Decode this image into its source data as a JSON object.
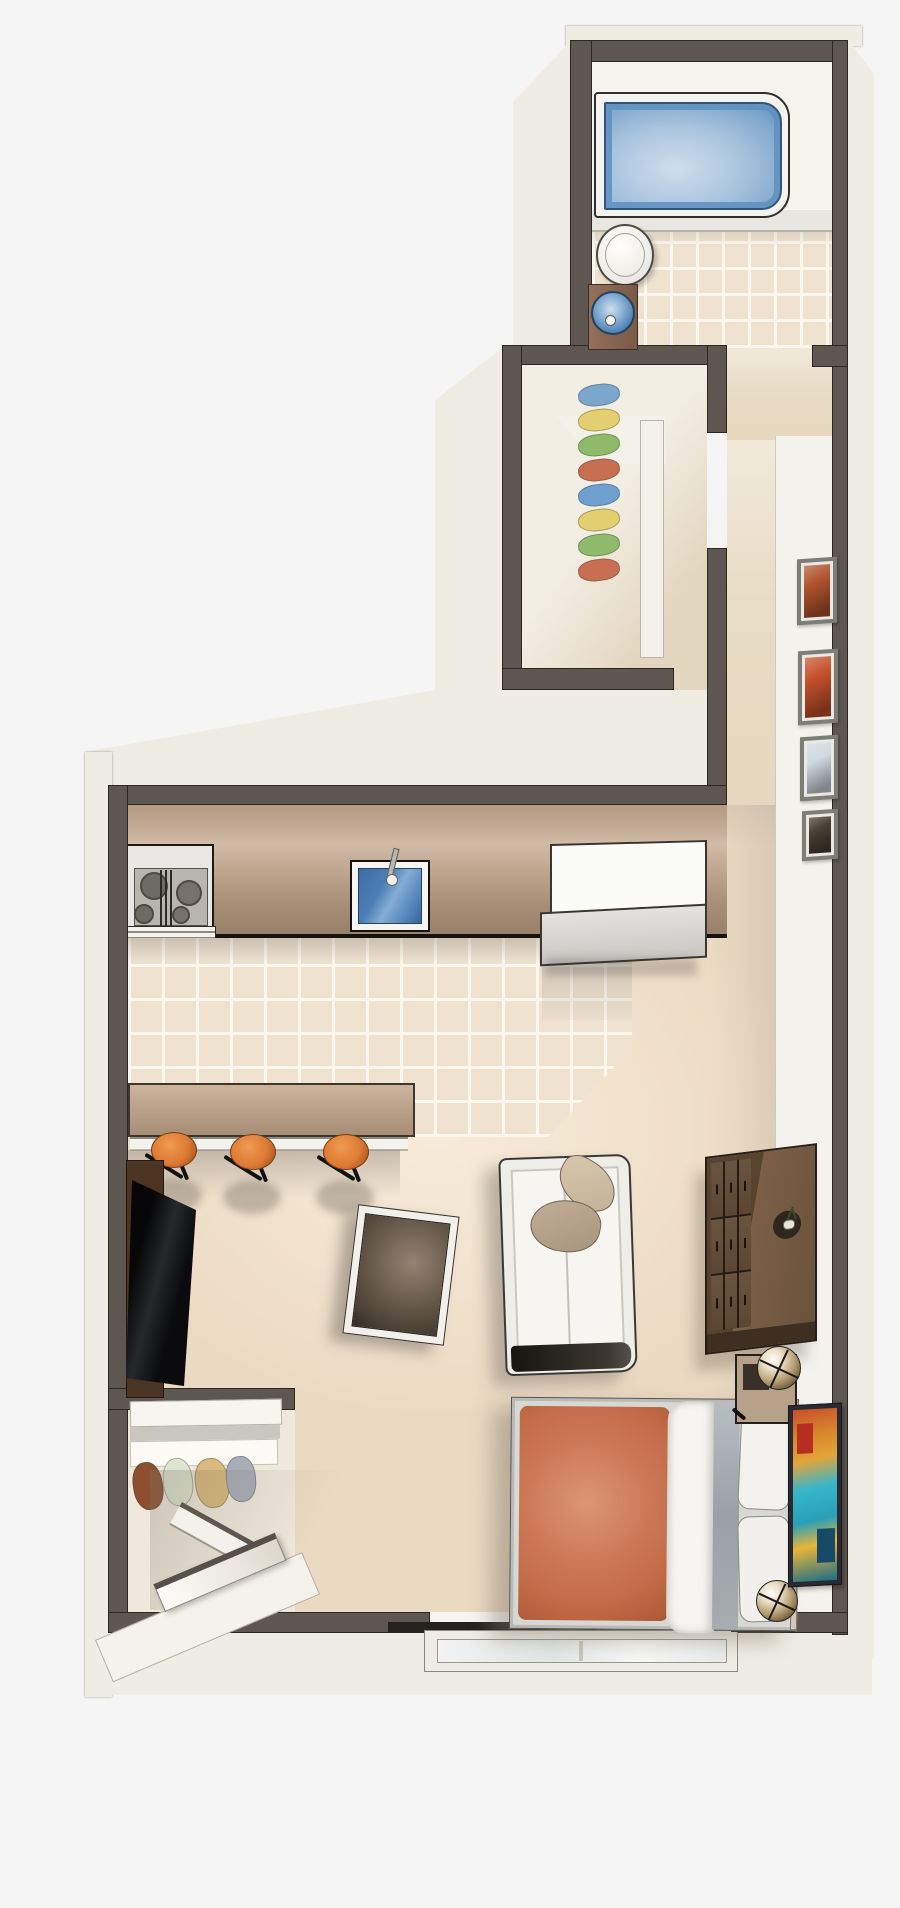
{
  "scene": {
    "kind": "isometric-floor-plan-illustration",
    "unit": "studio-apartment"
  },
  "palette": {
    "background": "#f5f5f6",
    "wall": "#5e5650",
    "wall_edge": "#2b2723",
    "outer_face": "#efede3",
    "band": "#f4f2ec",
    "bath_floor": "#f6f4ee",
    "tile": "#efe3d0",
    "grout": "#fbf7ee",
    "carpet": "#ebdac2",
    "closet_floor": "#f2eee4",
    "hall_floor": "#e9dcc4",
    "tub_blue": "#5d8fc0",
    "sink_blue": "#4a7eb5",
    "stool": "#dd7a33",
    "duvet": "#cd7a5a",
    "blanket": "#9aa0a6",
    "nightstand": "#b7a289",
    "dresser": "#6b523c",
    "drawer": "#5d4733",
    "tv": "#0b0b0d",
    "sofa": "#f6f5f1",
    "pillow": "#c3b097"
  },
  "rooms": [
    {
      "name": "bathroom"
    },
    {
      "name": "walk-in-closet"
    },
    {
      "name": "hallway"
    },
    {
      "name": "kitchen"
    },
    {
      "name": "living-area"
    },
    {
      "name": "sleeping-area"
    },
    {
      "name": "entry"
    }
  ],
  "furniture": {
    "bathroom": [
      "bathtub",
      "toilet",
      "sink-vanity"
    ],
    "closet": {
      "hanging_clothes_colors": [
        "#7ba7cc",
        "#e3cf6f",
        "#8fba6a",
        "#c96f51",
        "#6f9fd0",
        "#e3cf6f",
        "#8fba6a",
        "#c96f51"
      ]
    },
    "hallway": {
      "picture_frames": 4,
      "frame_art_primary": [
        "#b0542e",
        "#c4502a",
        "#cfd9e0",
        "#4a3f33"
      ]
    },
    "kitchen": {
      "appliances": [
        "range-stove",
        "kitchen-sink",
        "refrigerator"
      ],
      "burners": 4,
      "breakfast_bar": true,
      "bar_stools": 3
    },
    "living": [
      "tv",
      "media-console",
      "coffee-table",
      "sofa",
      "dresser"
    ],
    "sofa_pillows": 2,
    "dresser_drawers": 9,
    "bedroom": [
      "bed",
      "nightstand-upper",
      "nightstand-lower",
      "table-lamp-upper",
      "table-lamp-lower",
      "wall-art"
    ],
    "bed_layers": [
      "duvet",
      "folded-sheet",
      "blanket",
      "pillow",
      "pillow"
    ],
    "entry": [
      "entry-door-open",
      "coat-closet-shelf",
      "window"
    ],
    "entry_closet_clothes_colors": [
      "#8e4f31",
      "#dde4cf",
      "#d9ba7c",
      "#a8adb8"
    ]
  }
}
